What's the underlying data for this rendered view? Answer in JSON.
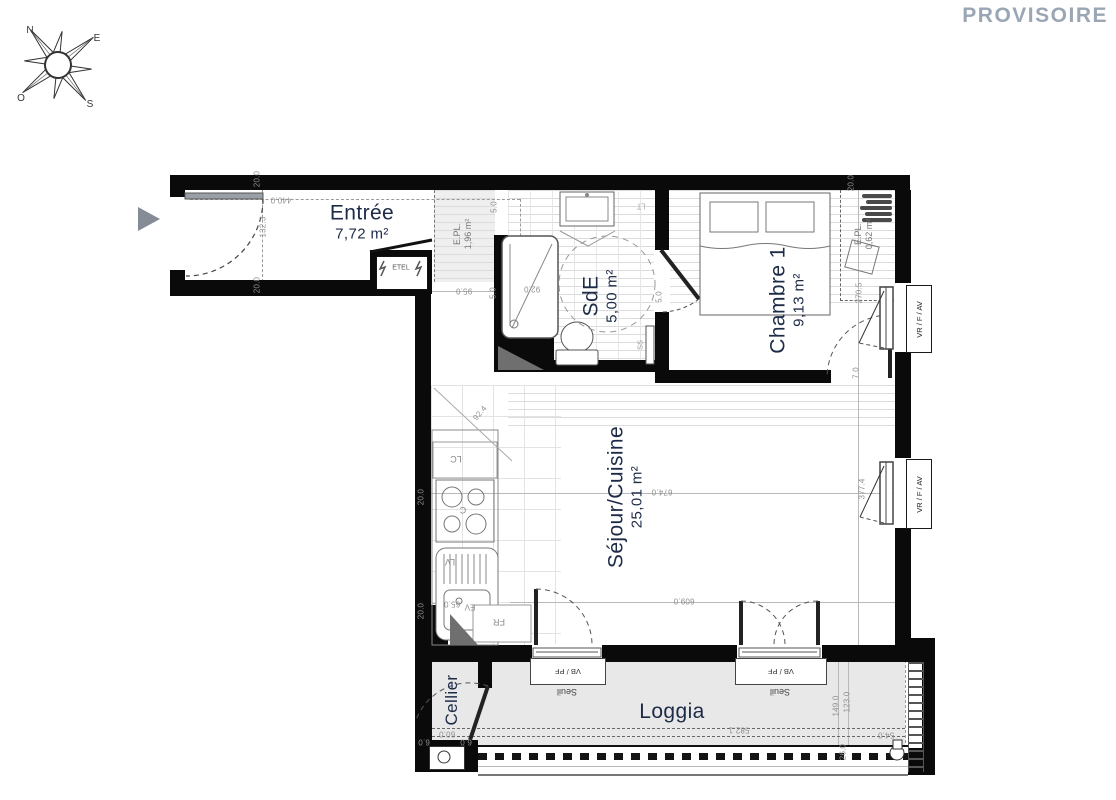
{
  "watermark": "PROVISOIRE",
  "compass": {
    "north": "N",
    "east": "E",
    "south": "S",
    "west": "O"
  },
  "rooms": {
    "entree": {
      "name": "Entrée",
      "area": "7,72 m²"
    },
    "sde": {
      "name": "SdE",
      "area": "5,00 m²"
    },
    "chambre": {
      "name": "Chambre 1",
      "area": "9,13 m²"
    },
    "sejour": {
      "name": "Séjour/Cuisine",
      "area": "25,01 m²"
    },
    "cellier": {
      "name": "Cellier"
    },
    "loggia": {
      "name": "Loggia"
    }
  },
  "closets": {
    "epl_sde": {
      "name": "E.PL.",
      "area": "1,96 m²"
    },
    "epl_chambre": {
      "name": "E.PL.",
      "area": "0,62 m²"
    }
  },
  "equipment": {
    "etel": "ETEL",
    "lc": "LC",
    "cooktop": "C",
    "lv": "LV",
    "ev": "EV",
    "fr": "FR",
    "lt": "LT",
    "ss": "SS"
  },
  "openings": {
    "vr_f_av": "VR / F / AV",
    "vb_pf": "VB / PF",
    "seuil": "Seuil"
  },
  "dimensions": [
    {
      "text": "20.0",
      "x": 257,
      "y": 179,
      "rot": -90
    },
    {
      "text": "440.0",
      "x": 281,
      "y": 200,
      "rot": 180
    },
    {
      "text": "132.3",
      "x": 263,
      "y": 227,
      "rot": -90
    },
    {
      "text": "20.0",
      "x": 257,
      "y": 285,
      "rot": -90
    },
    {
      "text": "95.0",
      "x": 464,
      "y": 291,
      "rot": 180
    },
    {
      "text": "5.0",
      "x": 494,
      "y": 207,
      "rot": -90
    },
    {
      "text": "5.0",
      "x": 493,
      "y": 293,
      "rot": -90
    },
    {
      "text": "5.0",
      "x": 659,
      "y": 297,
      "rot": -90
    },
    {
      "text": "92.0",
      "x": 532,
      "y": 289,
      "rot": 180
    },
    {
      "text": "92.4",
      "x": 480,
      "y": 413,
      "rot": -50
    },
    {
      "text": "20.0",
      "x": 421,
      "y": 497,
      "rot": -90
    },
    {
      "text": "20.0",
      "x": 421,
      "y": 611,
      "rot": -90
    },
    {
      "text": "65.0",
      "x": 452,
      "y": 604,
      "rot": 180
    },
    {
      "text": "674.0",
      "x": 662,
      "y": 492,
      "rot": 180
    },
    {
      "text": "609.0",
      "x": 684,
      "y": 601,
      "rot": 180
    },
    {
      "text": "20.0",
      "x": 851,
      "y": 183,
      "rot": -90
    },
    {
      "text": "270.5",
      "x": 859,
      "y": 293,
      "rot": -90
    },
    {
      "text": "7.0",
      "x": 856,
      "y": 373,
      "rot": -90
    },
    {
      "text": "377.4",
      "x": 862,
      "y": 489,
      "rot": -90
    },
    {
      "text": "582.1",
      "x": 739,
      "y": 730,
      "rot": 180
    },
    {
      "text": "149.0",
      "x": 836,
      "y": 706,
      "rot": -90
    },
    {
      "text": "123.0",
      "x": 847,
      "y": 702,
      "rot": -90
    },
    {
      "text": "26.0",
      "x": 843,
      "y": 752,
      "rot": -90
    },
    {
      "text": "54.0",
      "x": 886,
      "y": 735,
      "rot": 180
    },
    {
      "text": "60.0",
      "x": 447,
      "y": 734,
      "rot": 180
    },
    {
      "text": "6.0",
      "x": 424,
      "y": 742,
      "rot": 180
    },
    {
      "text": "6.0",
      "x": 466,
      "y": 742,
      "rot": 180
    }
  ]
}
